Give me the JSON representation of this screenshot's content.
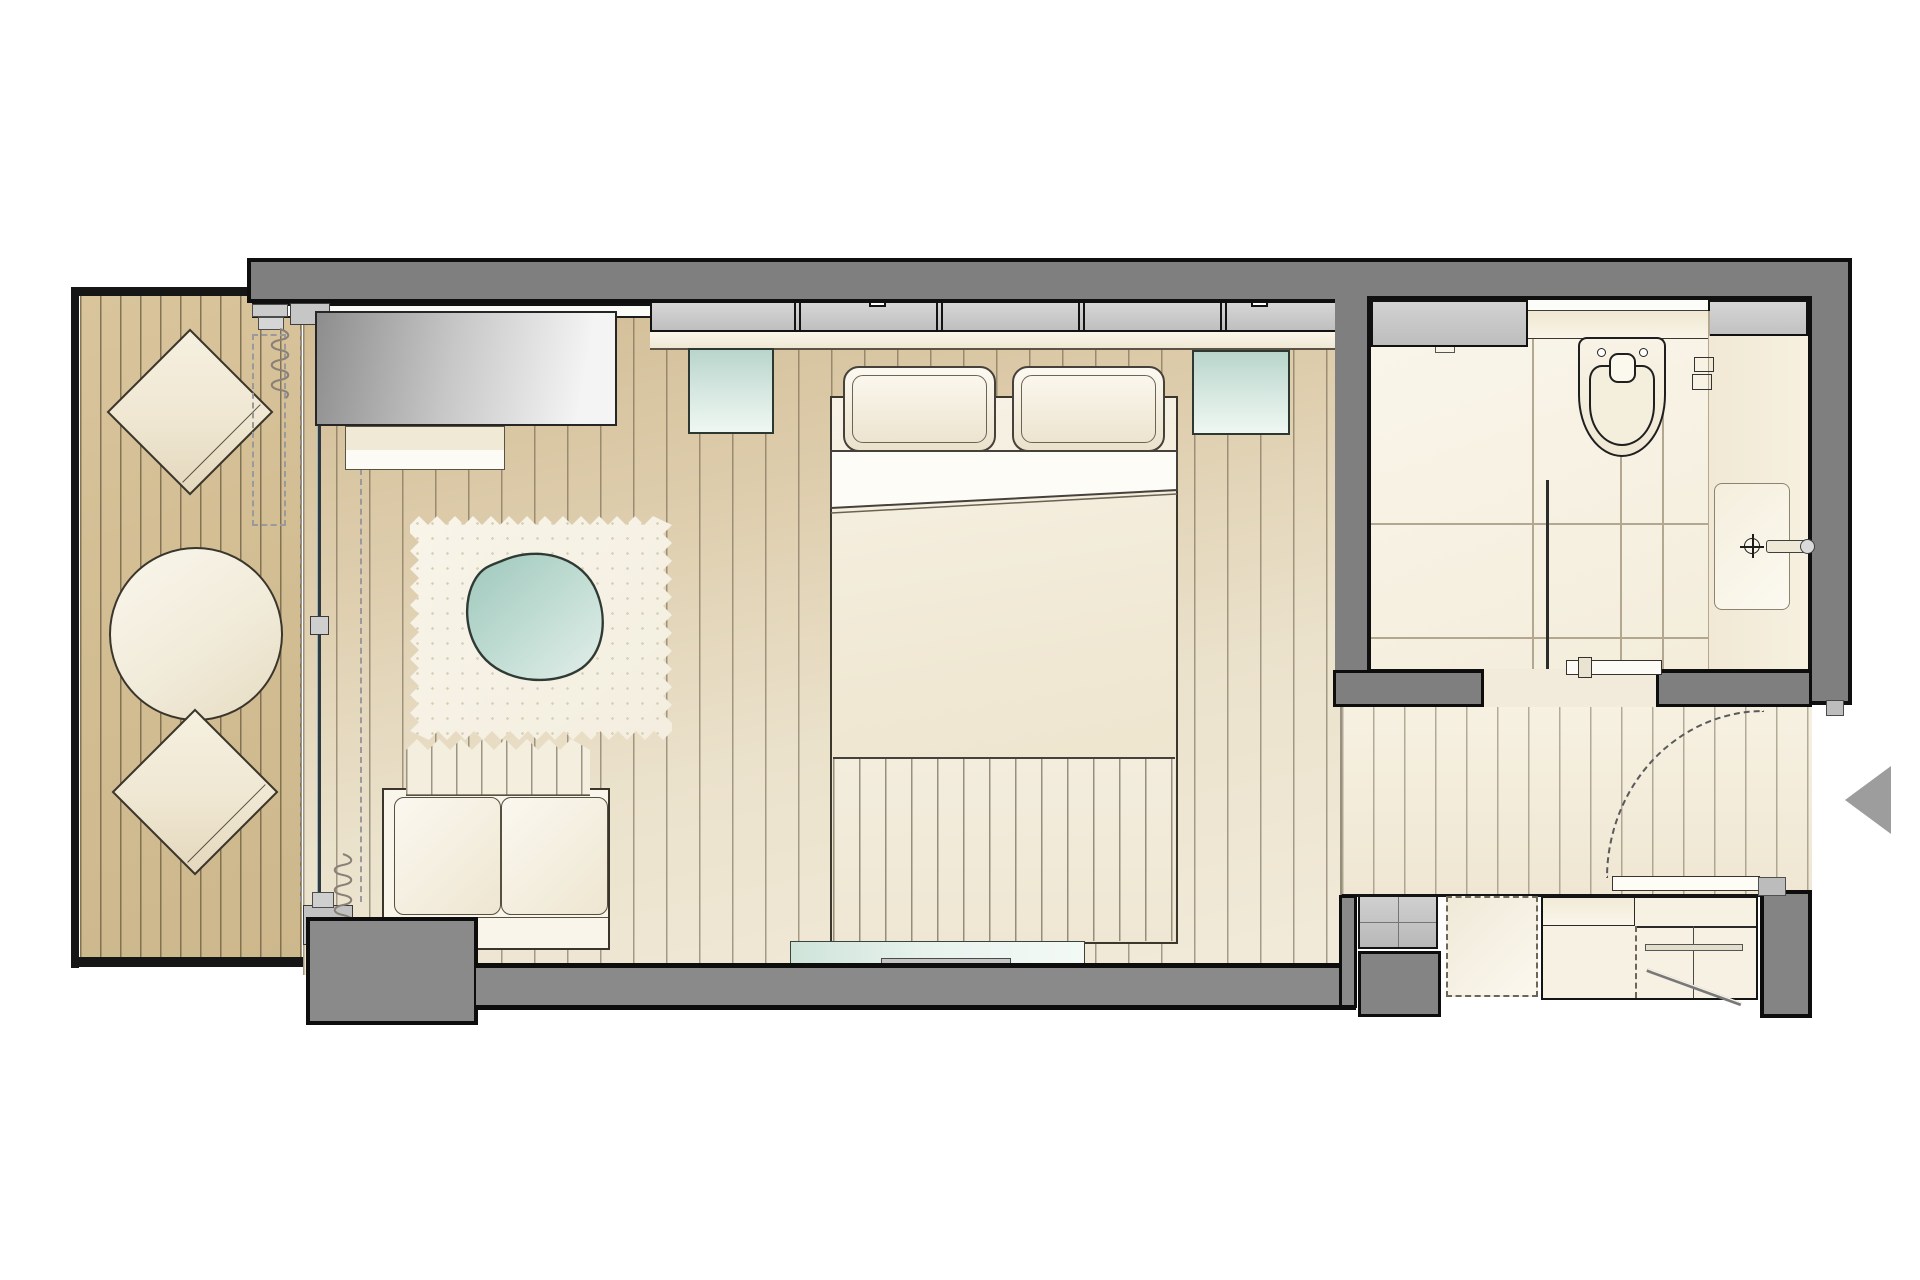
{
  "document": {
    "type": "architectural-floor-plan",
    "visible_text": [],
    "canvas": {
      "width": 1920,
      "height": 1280
    }
  },
  "palette": {
    "background": "#ffffff",
    "wall_gray": "#7f7f7f",
    "wall_outline_black": "#101010",
    "panel_gray": "#c6c6c6",
    "terrace_deck_tan": "#d3bd93",
    "bedroom_floor_tan": "#dccaa6",
    "corridor_floor_cream": "#f2ecdc",
    "furniture_cream": "#f1ead8",
    "glass_teal": "#c3dcd2",
    "rug_white": "#f6f2e6",
    "bathroom_floor": "#f6f0e2",
    "arrow_gray": "#9d9d9d"
  },
  "rooms": [
    {
      "id": "terrace",
      "elements": [
        "deck-planks",
        "square-side-table",
        "round-table",
        "square-side-table"
      ]
    },
    {
      "id": "bedroom",
      "elements": [
        "sliding-glass-door",
        "curtains",
        "tv-sideboard",
        "bench",
        "wardrobe-panels",
        "headboard-ledge",
        "nightstand-left",
        "nightstand-right",
        "double-bed",
        "pillows",
        "foot-throw",
        "area-rug",
        "sofa",
        "wall-mounted-tv"
      ]
    },
    {
      "id": "bathroom",
      "elements": [
        "shower",
        "shower-glass",
        "wall-hung-toilet",
        "flush-plate",
        "vanity-sink",
        "faucet",
        "mirror-panel",
        "storage-niche",
        "bathroom-door"
      ]
    },
    {
      "id": "entry",
      "elements": [
        "entry-door",
        "door-swing-arc",
        "entrance-arrow",
        "minibar-unit",
        "luggage-rack-dashed",
        "closet-with-rod",
        "wall-piers"
      ]
    }
  ]
}
